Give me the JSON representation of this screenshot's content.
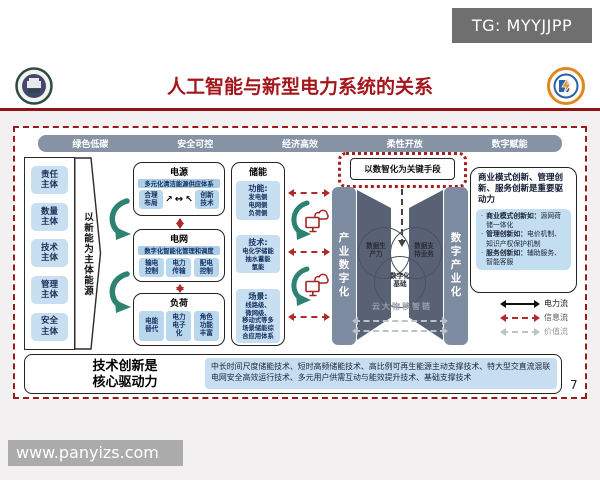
{
  "page": {
    "tg_badge": "TG: MYYJJPP",
    "watermark": "www.panyizs.com",
    "page_number": "7"
  },
  "header": {
    "title": "人工智能与新型电力系统的关系"
  },
  "top_bar": {
    "items": [
      "绿色低碳",
      "安全可控",
      "经济高效",
      "柔性开放",
      "数字赋能"
    ]
  },
  "subjects": {
    "items": [
      "责任\n主体",
      "数量\n主体",
      "技术\n主体",
      "管理\n主体",
      "安全\n主体"
    ],
    "arrow_label": "以新能为主体能源"
  },
  "source": {
    "title": "电源",
    "bar": "多元化清洁能源供应体系",
    "left": "合理\n布局",
    "right": "创新\n技术",
    "up_left": "↗",
    "up_right": "↖",
    "between": "↔"
  },
  "grid": {
    "title": "电网",
    "bar": "数字化智能化管理和调度",
    "items": [
      "输电\n控制",
      "电力\n传输",
      "配电\n控制"
    ]
  },
  "load": {
    "title": "负荷",
    "items": [
      "电能\n替代",
      "电力\n电子\n化",
      "角色\n功能\n丰富"
    ]
  },
  "storage": {
    "title": "储能",
    "groups": [
      {
        "label": "功能:",
        "body": "发电侧\n电网侧\n负荷侧"
      },
      {
        "label": "技术:",
        "body": "电化学储能\n抽水蓄能\n氢能"
      },
      {
        "label": "场景:",
        "body": "线路级、\n微网级、\n移动式等多\n场景储能综\n合应用体系"
      }
    ]
  },
  "digital": {
    "key_means": "以数智化为关键手段",
    "left_bar": "产业数字化",
    "right_bar": "数字产业化",
    "venn": [
      "数据生\n产力",
      "数据支\n持业务",
      "数字化\n基础"
    ],
    "foundation": "云大物移智链"
  },
  "right_panel": {
    "title": "商业模式创新、管理创新、服务创新是重要驱动力",
    "bullets": [
      {
        "lead": "商业模式创新如：",
        "rest": "源网荷储一体化"
      },
      {
        "lead": "管理创新如：",
        "rest": "电价机制、知识产权保护机制"
      },
      {
        "lead": "服务创新如：",
        "rest": "辅助服务、智能客服"
      }
    ]
  },
  "legend": {
    "items": [
      {
        "label": "电力流"
      },
      {
        "label": "信息流"
      },
      {
        "label": "价值流"
      }
    ]
  },
  "bottom": {
    "title": "技术创新是\n核心驱动力",
    "body": "中长时间尺度储能技术、短时高频储能技术、高比例可再生能源主动支撑技术、特大型交直流混联电网安全高效运行技术、多元用户供需互动与能效提升技术、基础支撑技术"
  },
  "colors": {
    "accent_red": "#9b1b1b",
    "bar_gray": "#8593a5",
    "light_blue": "#c8dff2",
    "slate_bar": "#7d8ca0",
    "wall": "#596175",
    "green_arrow": "#2d8272"
  }
}
